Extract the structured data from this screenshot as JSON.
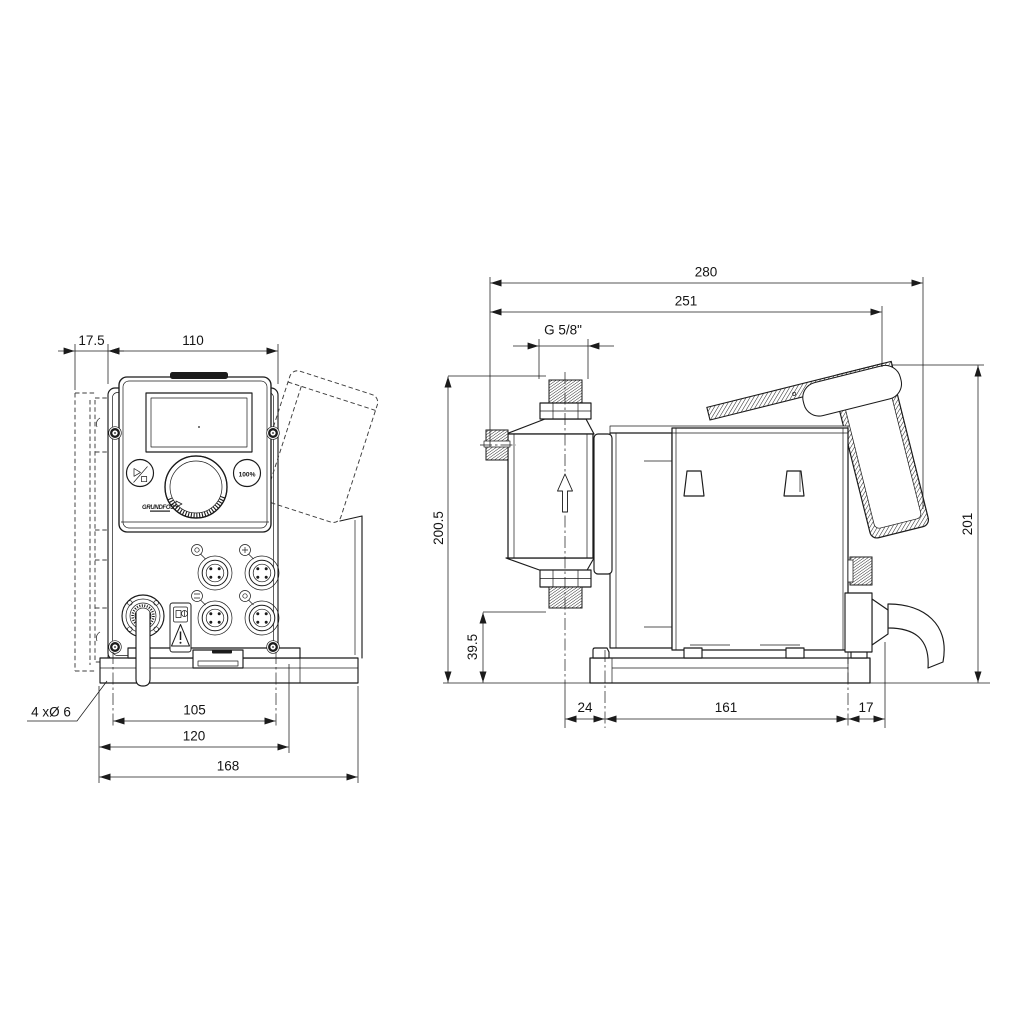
{
  "drawing_title": "Dosing pump dimensional drawing",
  "front_view": {
    "dims": {
      "side_offset": "17.5",
      "cube_width": "110",
      "mounting_holes": "4 xØ 6",
      "hole_spacing": "105",
      "bracket_width": "120",
      "base_width": "168"
    },
    "panel": {
      "run_button": "100%",
      "logo": "GRUNDFOS"
    }
  },
  "side_view": {
    "dims": {
      "overall_length": "280",
      "length_to_rear": "251",
      "connection_thread": "G 5/8\"",
      "connection_height": "200.5",
      "suction_height": "39.5",
      "overall_height": "201",
      "head_offset": "24",
      "hole_spacing": "161",
      "rear_offset": "17"
    }
  },
  "colors": {
    "line": "#1b1b1b",
    "background": "#ffffff"
  },
  "icons": {
    "start_stop": "play-stop-symbol",
    "warning": "warning-triangle",
    "manual": "read-manual-pictogram",
    "flow": "up-arrow"
  }
}
